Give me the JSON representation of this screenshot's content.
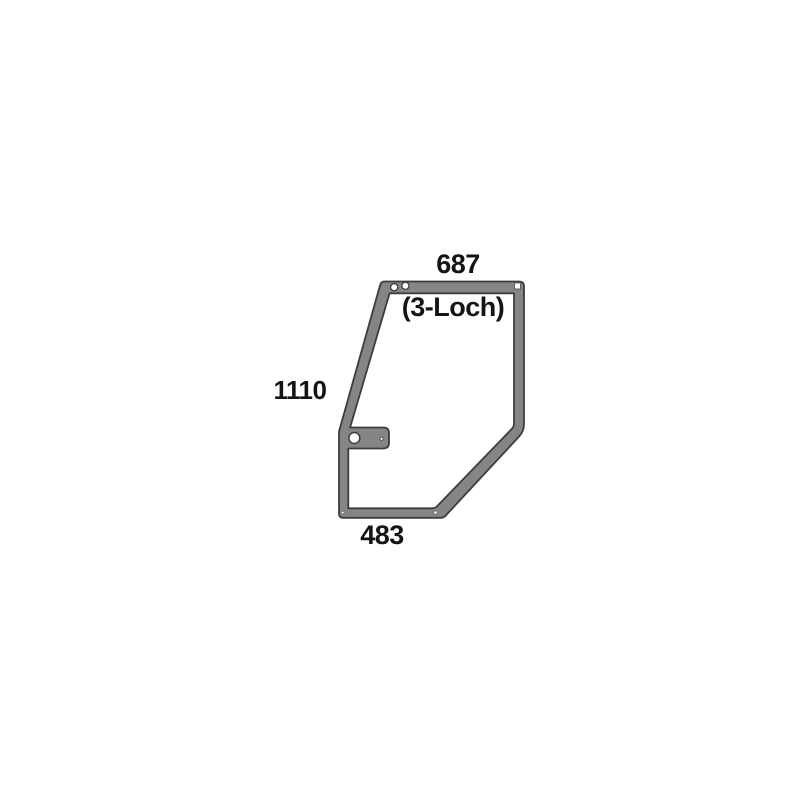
{
  "diagram": {
    "labels": {
      "top_width": "687",
      "left_height": "1110",
      "bottom_width": "483",
      "hole_note": "(3-Loch)"
    },
    "colors": {
      "background": "#ffffff",
      "frame_fill": "#858585",
      "frame_outline": "#3d3d3d",
      "hole_fill": "#ffffff",
      "text": "#141414"
    },
    "features": {
      "top_edge_round_holes": 2,
      "tab_round_holes": 1,
      "top_right_square_hole": 1
    }
  }
}
